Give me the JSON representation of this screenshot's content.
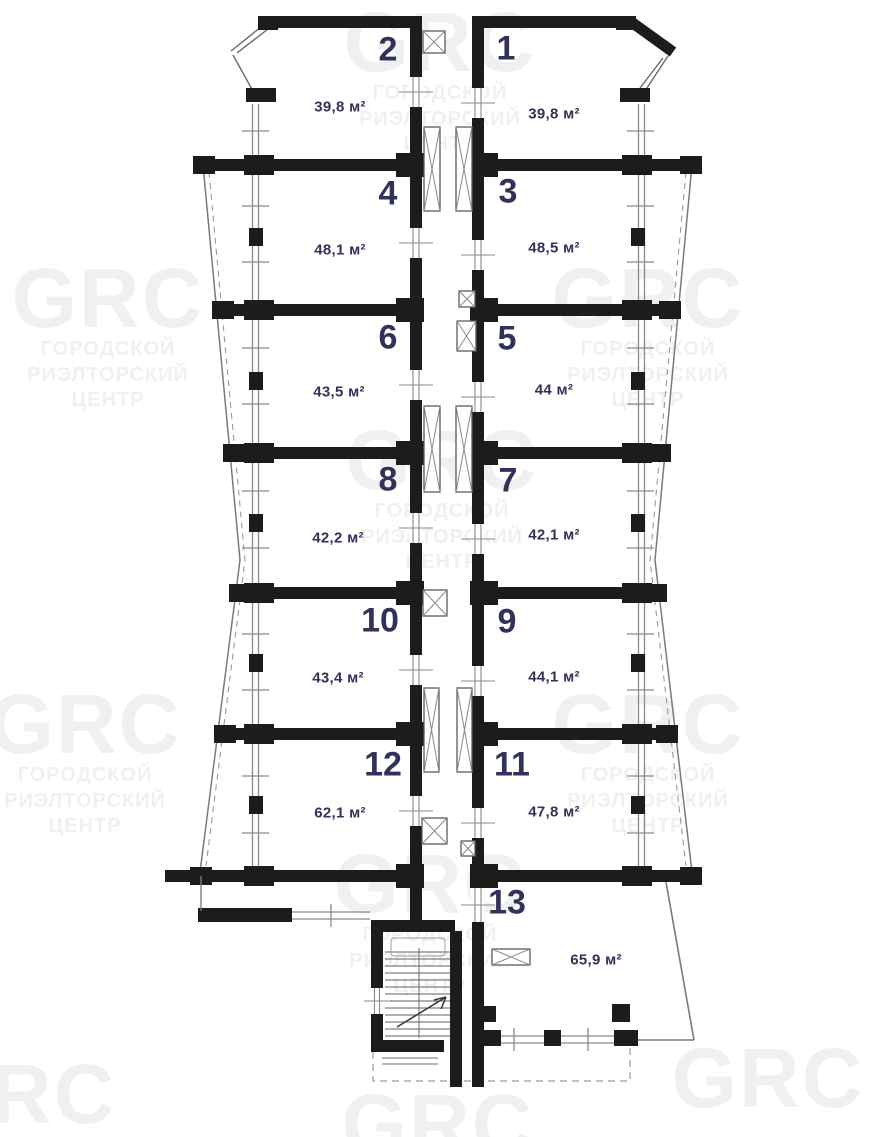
{
  "watermark": {
    "logo": "GRC",
    "line1": "ГОРОДСКОЙ",
    "line2": "РИЭЛТОРСКИЙ",
    "line3": "ЦЕНТР"
  },
  "units": [
    {
      "id": "1",
      "area": "39,8 м²"
    },
    {
      "id": "2",
      "area": "39,8 м²"
    },
    {
      "id": "3",
      "area": "48,5 м²"
    },
    {
      "id": "4",
      "area": "48,1 м²"
    },
    {
      "id": "5",
      "area": "44 м²"
    },
    {
      "id": "6",
      "area": "43,5 м²"
    },
    {
      "id": "7",
      "area": "42,1 м²"
    },
    {
      "id": "8",
      "area": "42,2 м²"
    },
    {
      "id": "9",
      "area": "44,1 м²"
    },
    {
      "id": "10",
      "area": "43,4 м²"
    },
    {
      "id": "11",
      "area": "47,8 м²"
    },
    {
      "id": "12",
      "area": "62,1 м²"
    },
    {
      "id": "13",
      "area": "65,9 м²"
    }
  ],
  "colors": {
    "wall": "#1c1c1c",
    "label": "#31325a",
    "thin_line": "#8a8a8a",
    "background": "#ffffff"
  }
}
